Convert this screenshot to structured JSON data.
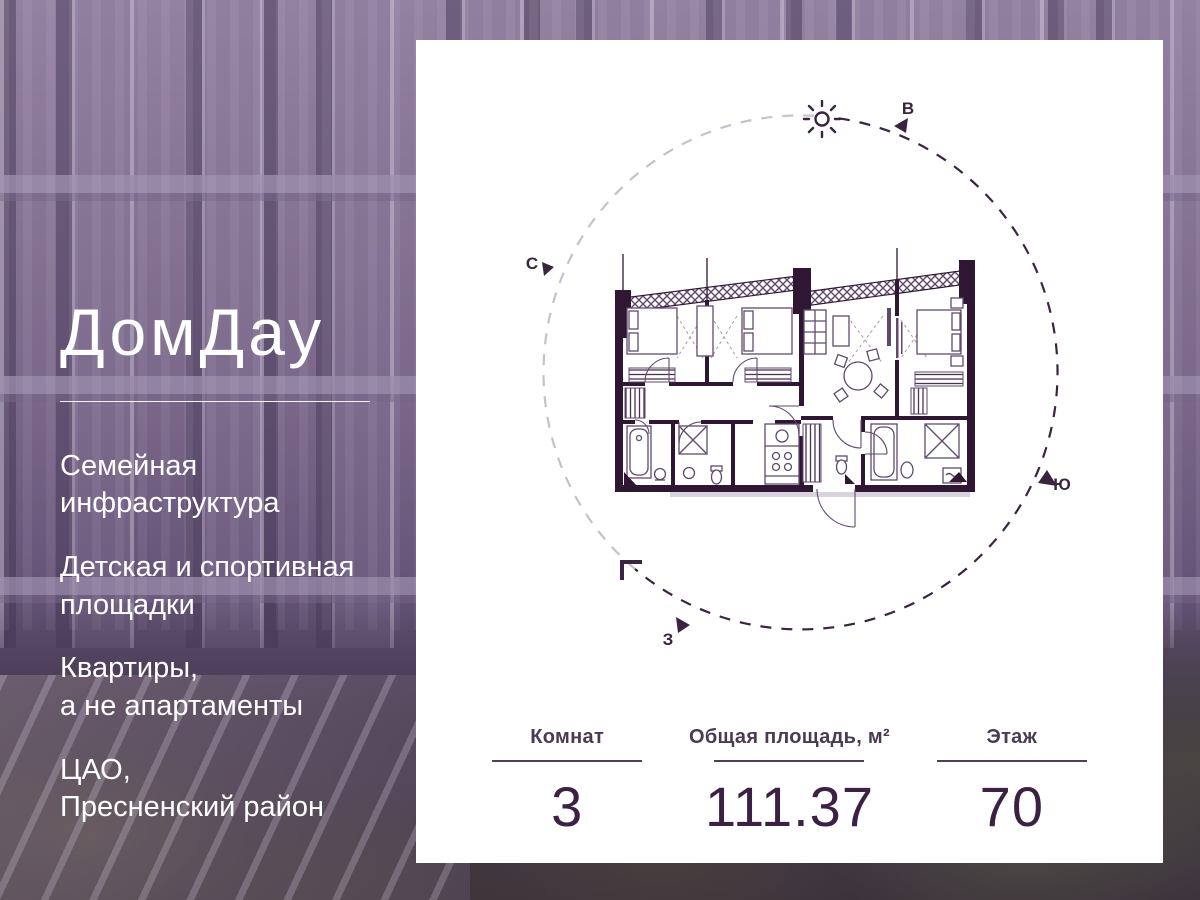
{
  "brand": {
    "name": "ДомДау"
  },
  "left_panel": {
    "features": [
      "Семейная\nинфраструктура",
      "Детская и спортивная\nплощадки",
      "Квартиры,\nа не апартаменты",
      "ЦАО,\nПресненский район"
    ]
  },
  "card": {
    "compass": {
      "north": "С",
      "east": "В",
      "south": "Ю",
      "west": "З"
    },
    "stats": [
      {
        "label": "Комнат",
        "value": "3"
      },
      {
        "label": "Общая площадь, м²",
        "value": "111.37"
      },
      {
        "label": "Этаж",
        "value": "70"
      }
    ]
  },
  "colors": {
    "accent_dark": "#3a2540",
    "wall": "#2f1733",
    "furniture": "#5f4a6e",
    "circle_light": "#c7c0cd",
    "card_bg": "#ffffff",
    "text_light": "#ffffff"
  }
}
